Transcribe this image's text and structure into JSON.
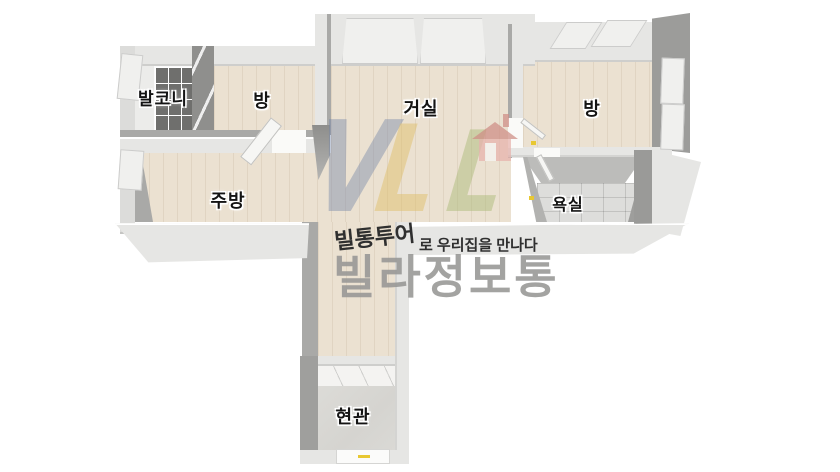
{
  "plan": {
    "rooms": {
      "balcony": "발코니",
      "room_left": "방",
      "living": "거실",
      "room_right": "방",
      "kitchen": "주방",
      "bathroom": "욕실",
      "entrance": "현관"
    }
  },
  "watermark": {
    "letters": [
      "V",
      "L",
      "L"
    ],
    "tagline_bold": "빌통투어",
    "tagline_rest": "로 우리집을 만나다",
    "logo": "빌라정보통"
  },
  "colors": {
    "wood_floor": "#ebe1d1",
    "tile_floor": "#dddddb",
    "entry_floor": "#d8d7d3",
    "wall_top": "#e6e6e4",
    "wall_face": "#a9a9a7",
    "wall_deep": "#8f8f8d",
    "window_glass": "#6f6f6d",
    "logo_gray": "#979795",
    "tagline_dark": "#2f2f2f",
    "letter_blue": "#7385a8",
    "letter_yellow": "#debd62",
    "letter_green": "#a8b973",
    "house_roof": "#cf8d85",
    "house_body": "#e7b3ad",
    "accent_yellow": "#e8c832"
  }
}
